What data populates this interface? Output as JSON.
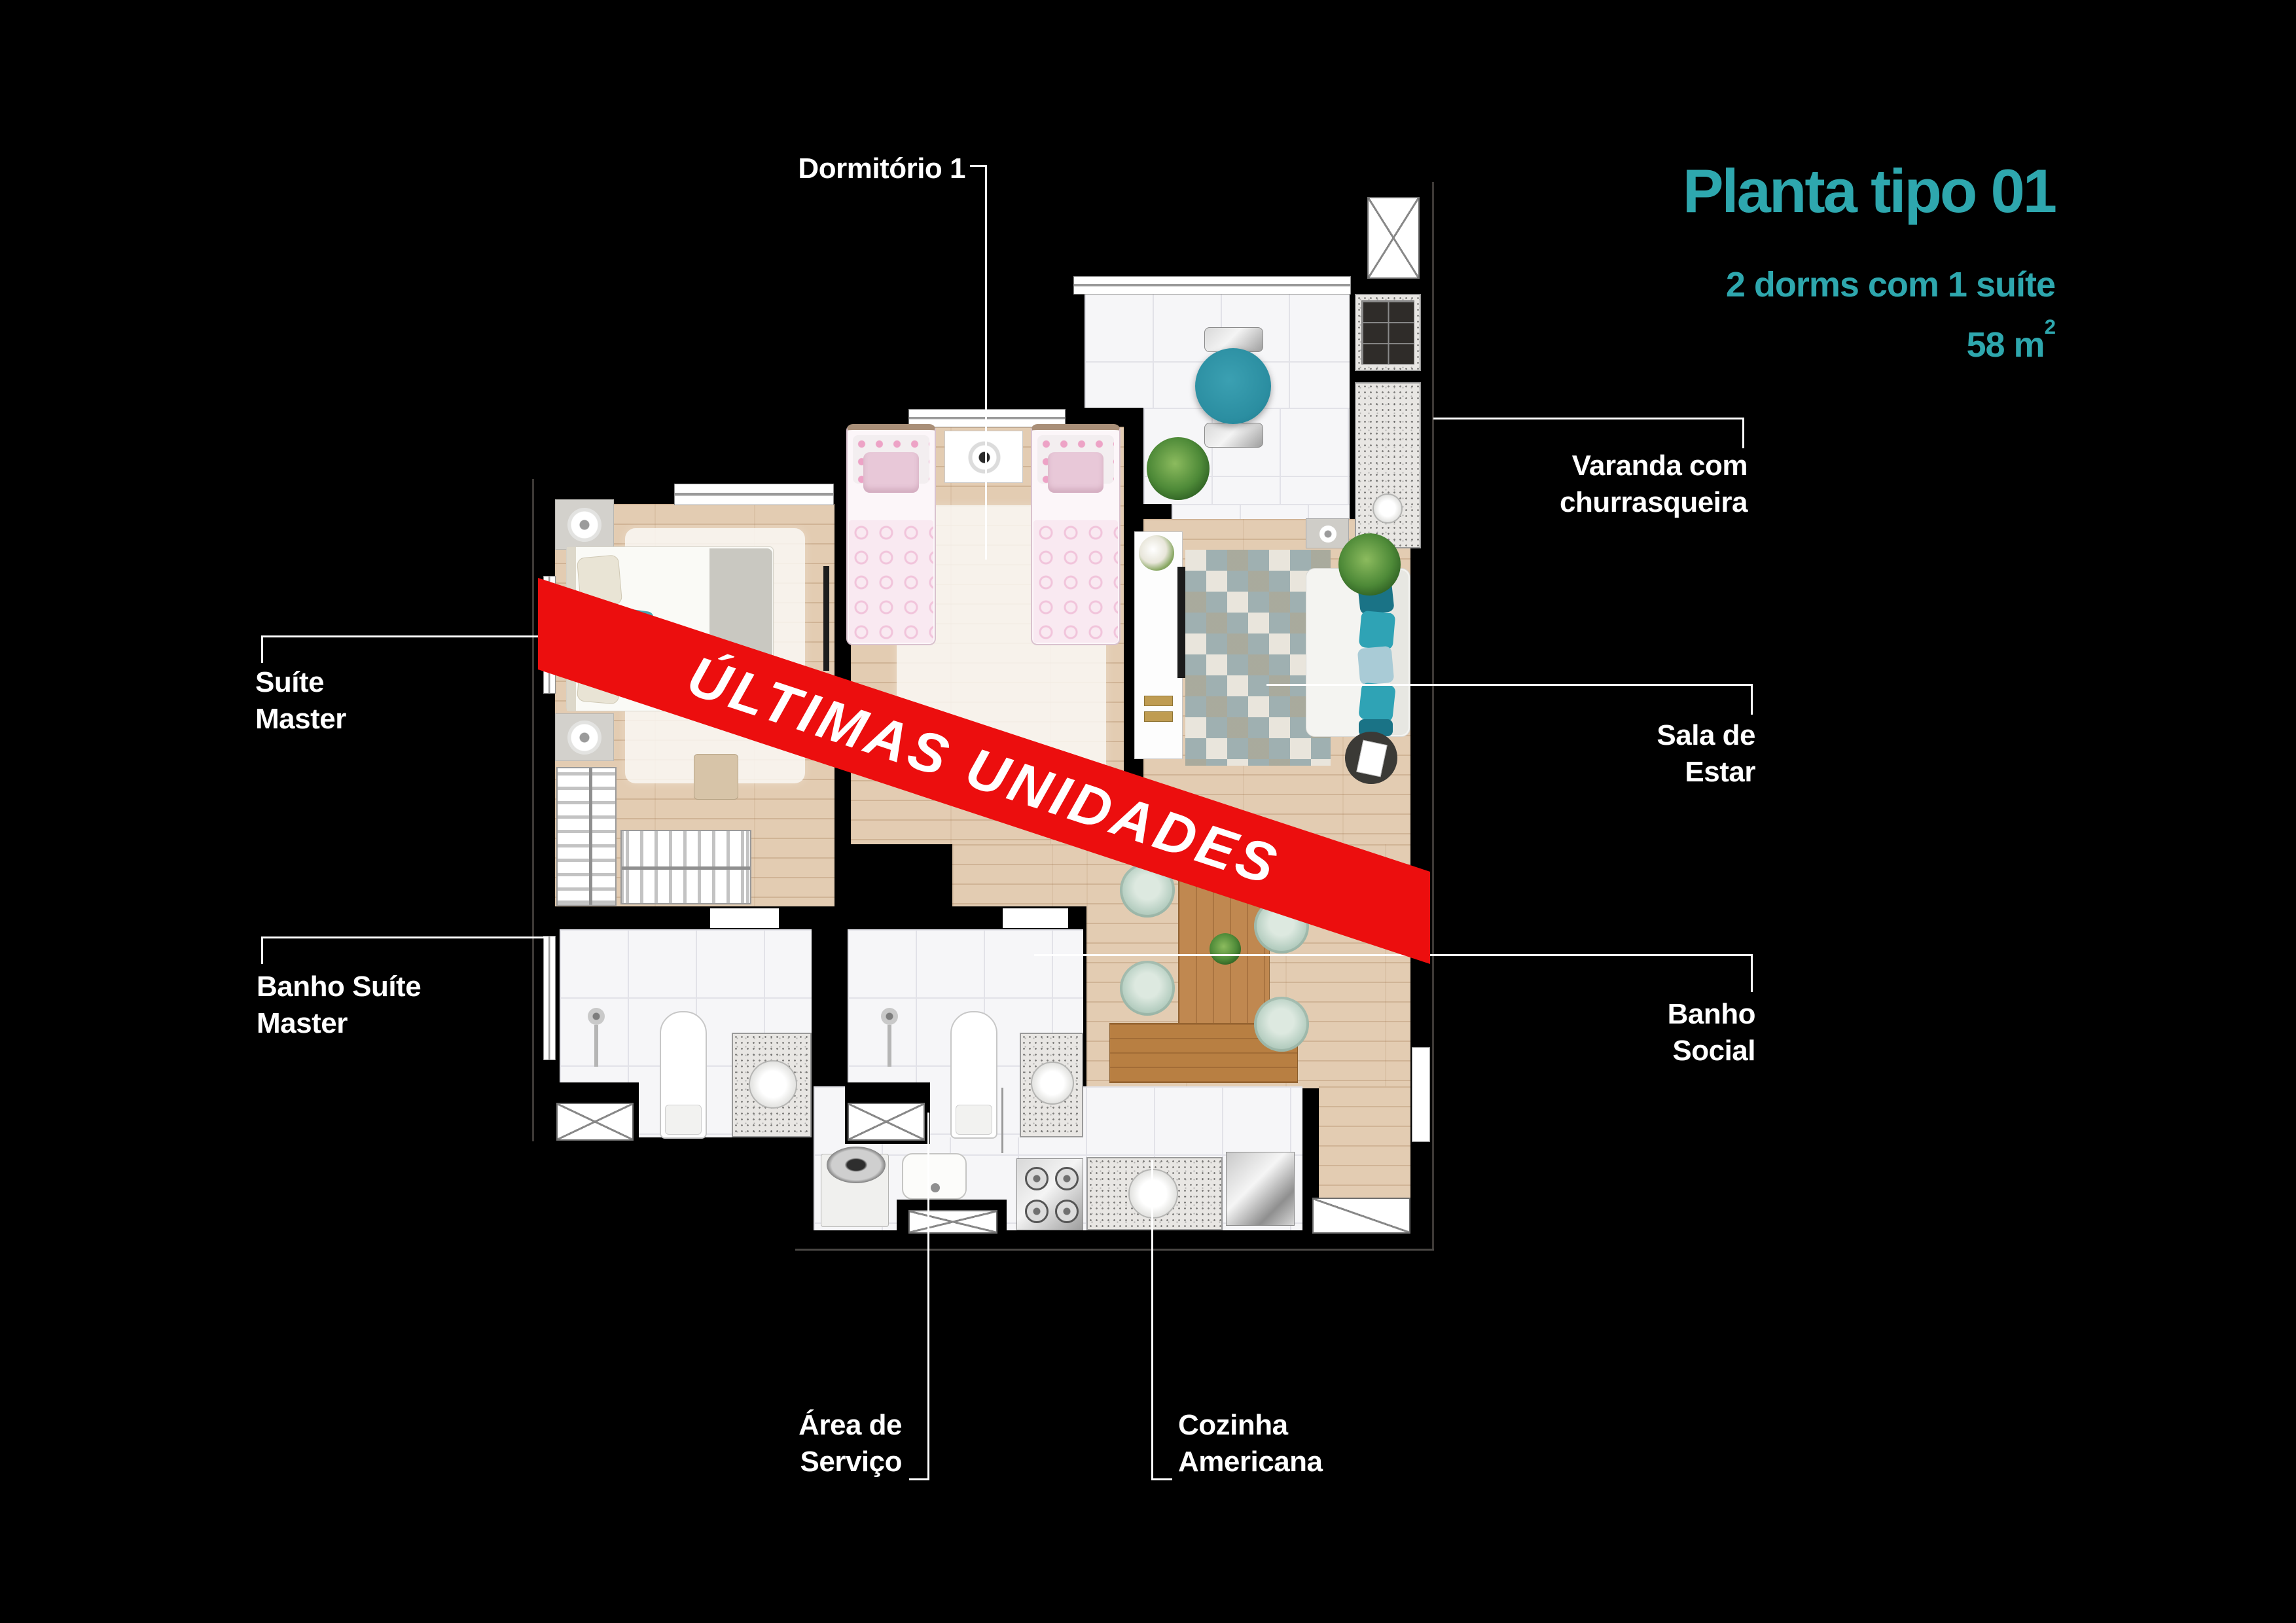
{
  "title": {
    "heading": "Planta tipo 01",
    "subtitle": "2 dorms com 1 suíte",
    "area": "58 m",
    "area_sup": "2"
  },
  "banner": {
    "text": "ÚLTIMAS UNIDADES"
  },
  "callouts": {
    "dormitorio1": {
      "lines": [
        "Dormitório 1"
      ]
    },
    "suite_master": {
      "lines": [
        "Suíte",
        "Master"
      ]
    },
    "banho_suite": {
      "lines": [
        "Banho Suíte",
        "Master"
      ]
    },
    "varanda": {
      "lines": [
        "Varanda com",
        "churrasqueira"
      ]
    },
    "sala_estar": {
      "lines": [
        "Sala de",
        "Estar"
      ]
    },
    "banho_social": {
      "lines": [
        "Banho",
        "Social"
      ]
    },
    "area_servico": {
      "lines": [
        "Área de",
        "Serviço"
      ]
    },
    "cozinha": {
      "lines": [
        "Cozinha",
        "Americana"
      ]
    }
  },
  "colors": {
    "accent_teal": "#2EA7AE",
    "banner_red": "#EC0E0E"
  }
}
